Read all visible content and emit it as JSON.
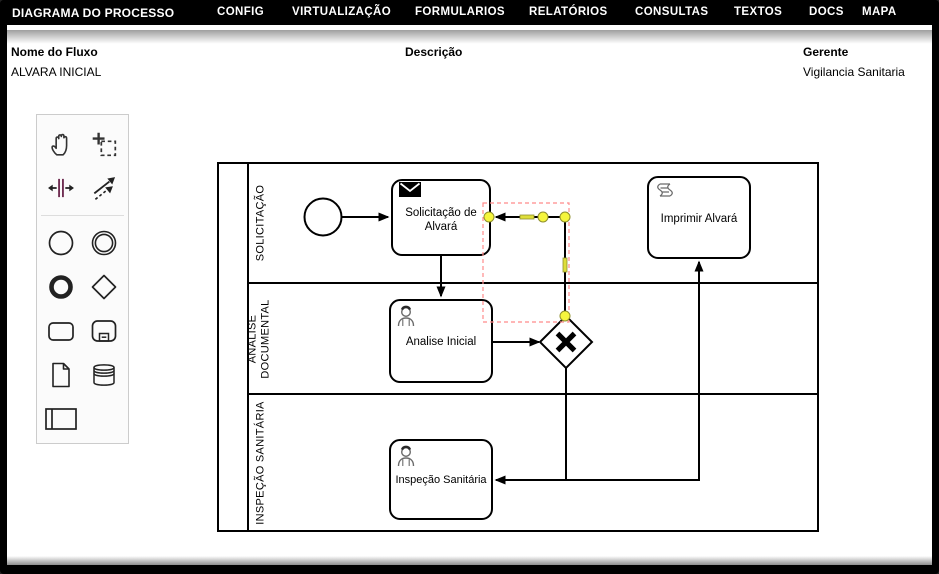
{
  "menubar": {
    "items": [
      {
        "label": "DIAGRAMA DO PROCESSO"
      },
      {
        "label": "CONFIG"
      },
      {
        "label": "VIRTUALIZAÇÃO"
      },
      {
        "label": "FORMULARIOS"
      },
      {
        "label": "RELATÓRIOS"
      },
      {
        "label": "CONSULTAS"
      },
      {
        "label": "TEXTOS"
      },
      {
        "label": "DOCS"
      },
      {
        "label": "MAPA"
      }
    ]
  },
  "header": {
    "flow_name_label": "Nome do Fluxo",
    "flow_name_value": "ALVARA INICIAL",
    "description_label": "Descrição",
    "description_value": "",
    "manager_label": "Gerente",
    "manager_value": "Vigilancia Sanitaria"
  },
  "palette": {
    "tools": [
      {
        "name": "hand-tool-icon"
      },
      {
        "name": "lasso-tool-icon"
      },
      {
        "name": "space-tool-icon"
      },
      {
        "name": "global-connect-tool-icon"
      },
      {
        "name": "start-event-icon"
      },
      {
        "name": "intermediate-event-icon"
      },
      {
        "name": "end-event-icon"
      },
      {
        "name": "gateway-icon"
      },
      {
        "name": "task-icon"
      },
      {
        "name": "subprocess-icon"
      },
      {
        "name": "data-object-icon"
      },
      {
        "name": "data-store-icon"
      },
      {
        "name": "participant-pool-icon"
      }
    ]
  },
  "diagram": {
    "lanes": [
      {
        "label": "SOLICITAÇÃO"
      },
      {
        "label": "ANALISE\nDOCUMENTAL"
      },
      {
        "label": "INSPEÇÃO SANITÁRIA"
      }
    ],
    "nodes": {
      "solicitacao": {
        "label": "Solicitação de\nAlvará",
        "icon": "message-icon"
      },
      "imprimir": {
        "label": "Imprimir Alvará",
        "icon": "script-icon"
      },
      "analise": {
        "label": "Analise Inicial",
        "icon": "user-icon"
      },
      "inspecao": {
        "label": "Inspeção Sanitária",
        "icon": "user-icon"
      }
    },
    "selection": {
      "outline_color": "#ff8b8b",
      "handle_fill": "#f5f53d",
      "handle_stroke": "#8f8f2e"
    }
  }
}
